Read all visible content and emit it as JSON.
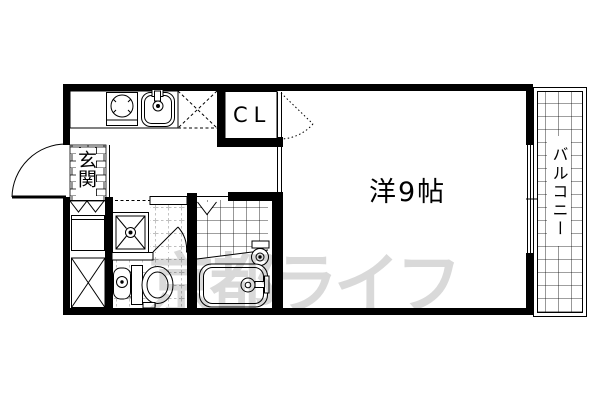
{
  "labels": {
    "entrance": "玄関",
    "closet": "CL",
    "main_room": "洋9帖",
    "balcony": "バルコニー"
  },
  "watermark_text": "京都ライフ",
  "colors": {
    "line": "#000000",
    "background": "#ffffff",
    "watermark": "#d9d9d9"
  }
}
